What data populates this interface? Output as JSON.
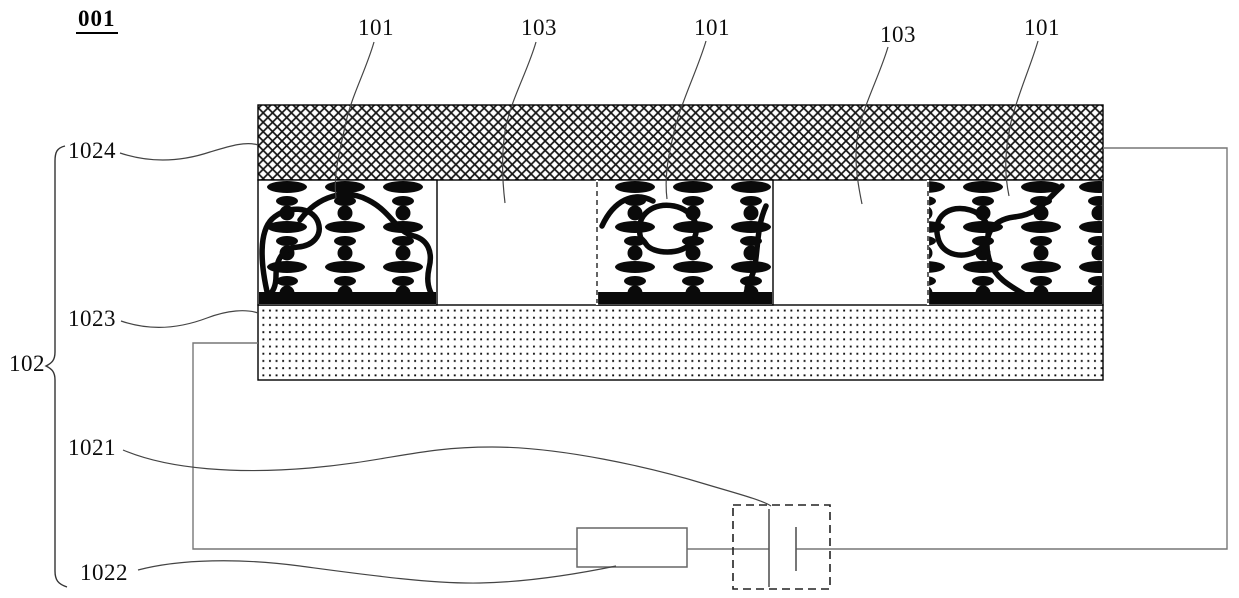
{
  "figure": {
    "id": "001"
  },
  "callouts": {
    "top": [
      {
        "label": "101"
      },
      {
        "label": "103"
      },
      {
        "label": "101"
      },
      {
        "label": "103"
      },
      {
        "label": "101"
      }
    ],
    "left": [
      {
        "label": "1024"
      },
      {
        "label": "1023"
      },
      {
        "label": "102"
      },
      {
        "label": "1021"
      },
      {
        "label": "1022"
      }
    ]
  },
  "colors": {
    "ink": "#0a0a0a",
    "wire": "#777777",
    "leader": "#444444",
    "background": "#ffffff"
  }
}
